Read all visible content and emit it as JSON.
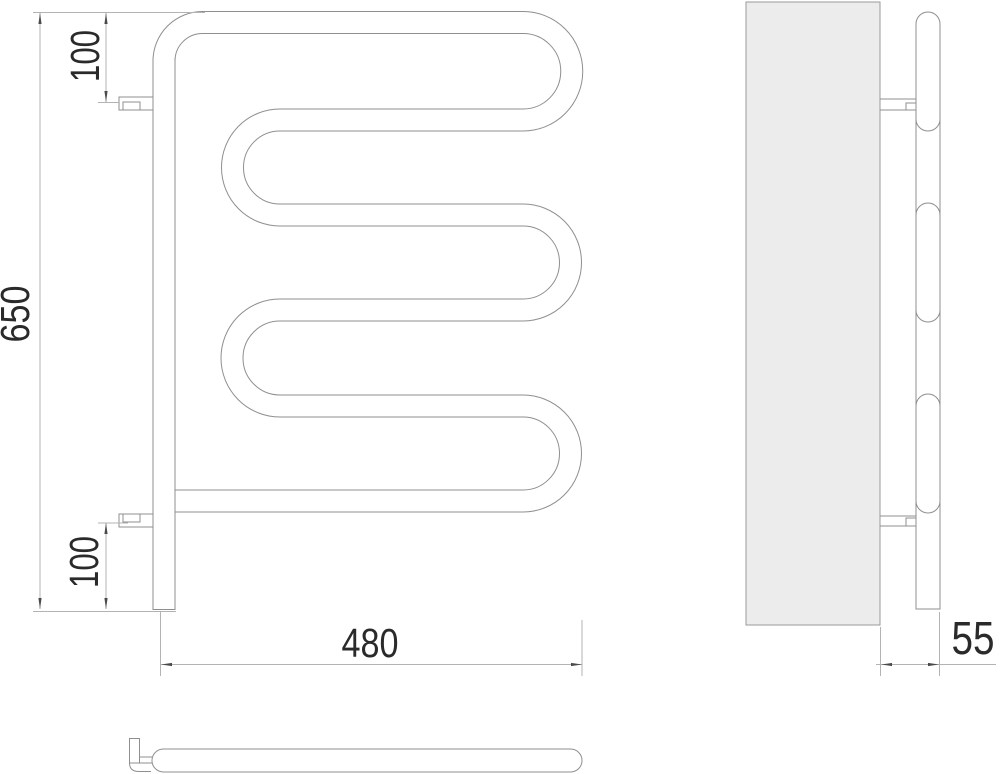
{
  "dimensions": {
    "height": "650",
    "width": "480",
    "depth": "55",
    "top_bracket_offset": "100",
    "bottom_bracket_offset": "100"
  },
  "colors": {
    "outline": "#8f8f8f",
    "dim_line": "#b3b3b3",
    "text": "#2a2a2a",
    "panel_fill": "#ececec"
  }
}
